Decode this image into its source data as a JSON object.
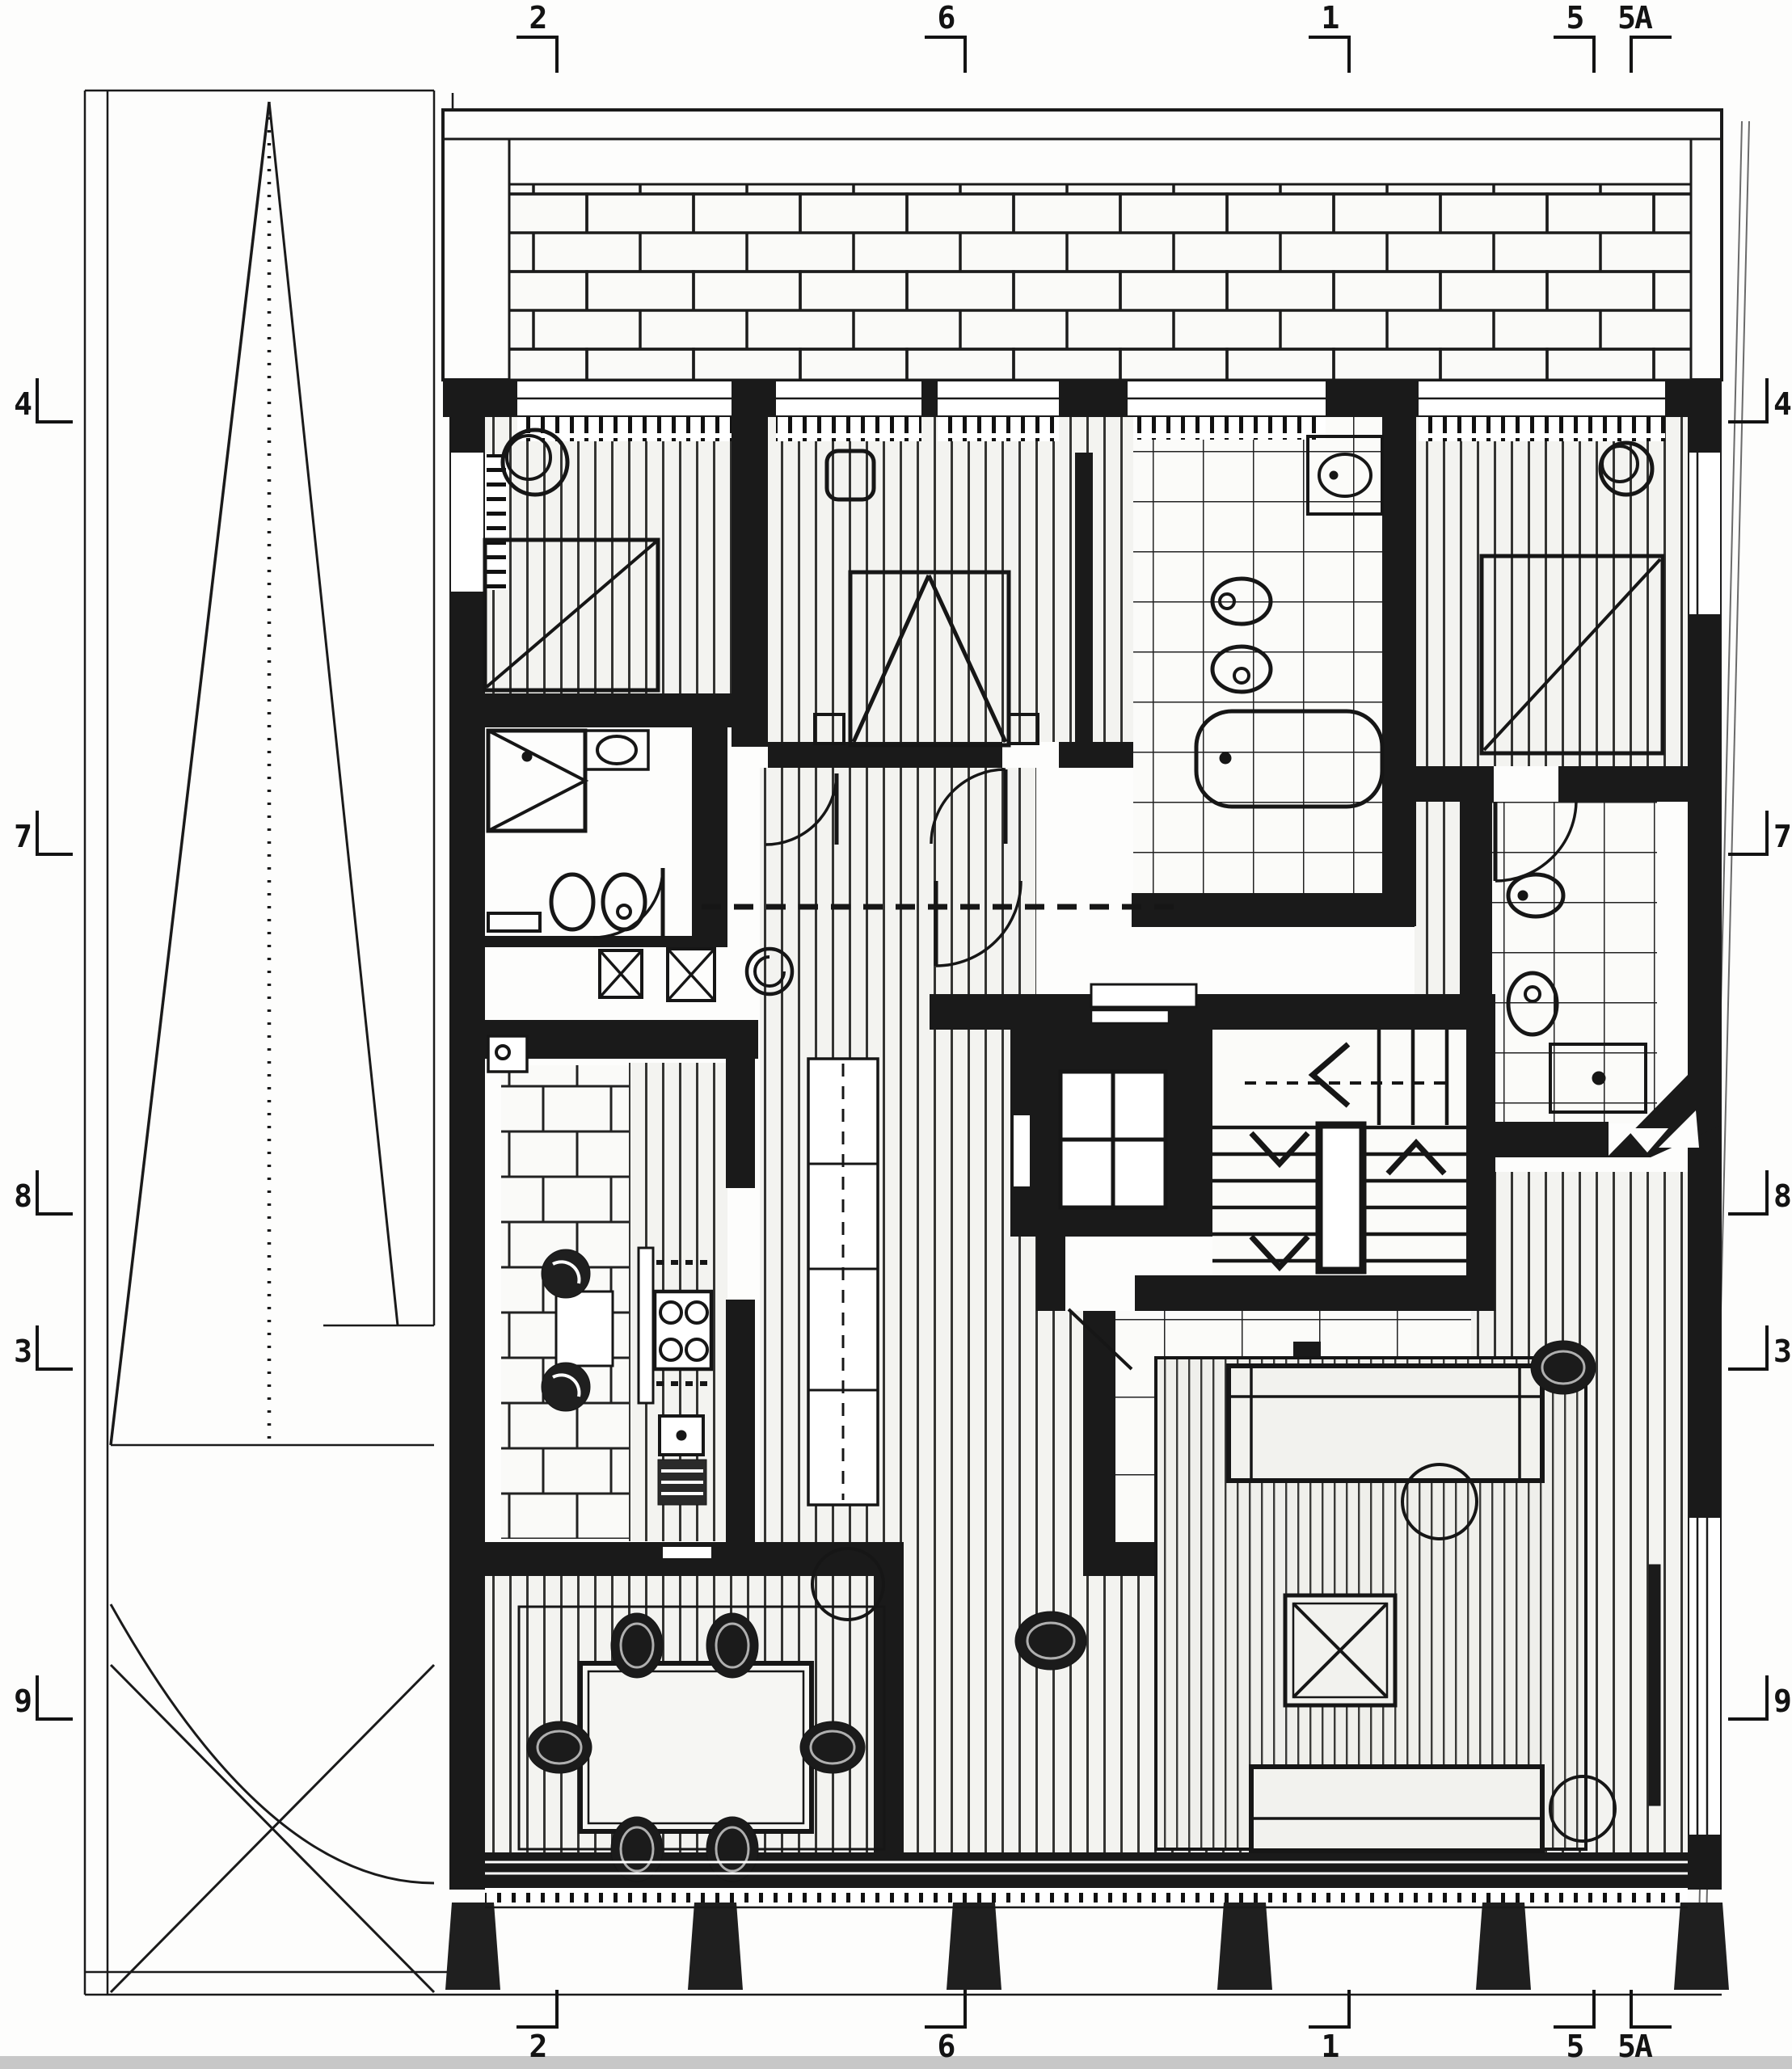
{
  "drawing": {
    "kind": "architectural floor plan sheet, upper apartment storey with roof terrace, stair core and elevator",
    "grid_markers": {
      "top": [
        "2",
        "6",
        "1",
        "5",
        "5A"
      ],
      "bottom": [
        "2",
        "6",
        "1",
        "5",
        "5A"
      ],
      "left": [
        "4",
        "7",
        "8",
        "3",
        "9"
      ],
      "right": [
        "4",
        "7",
        "8",
        "3",
        "9"
      ]
    },
    "colors": {
      "ink": "#1a1a1a",
      "paper": "#fdfdfc",
      "floor_hatch": "#f3f3f0",
      "scan_strip": "#c7c7c7"
    },
    "icons": [
      "bed-icon",
      "armchair-icon",
      "wardrobe-triangle-icon",
      "bathtub-icon",
      "toilet-icon",
      "bidet-icon",
      "washbasin-icon",
      "shower-icon",
      "washer-icon",
      "boiler-icon",
      "kitchen-sink-icon",
      "stove-burners-icon",
      "oven-icon",
      "grill-icon",
      "dining-table-icon",
      "chair-icon",
      "floor-lamp-icon",
      "sofa-icon",
      "side-table-icon",
      "coffee-table-icon",
      "pouf-icon",
      "elevator-icon",
      "stair-flight-icon",
      "stair-direction-arrow-icon",
      "door-swing-icon",
      "tree-boundary-icon",
      "brick-paving-icon"
    ]
  }
}
